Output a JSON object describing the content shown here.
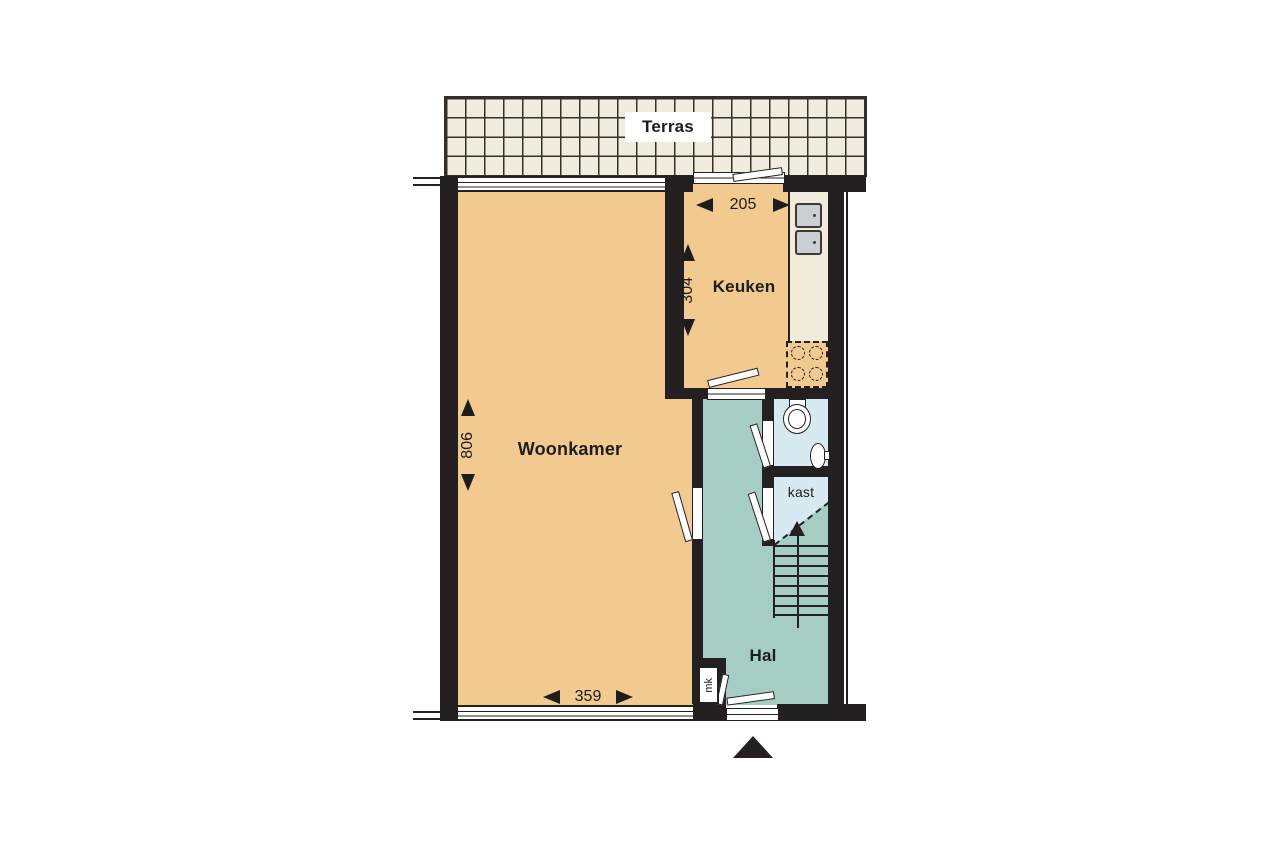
{
  "rooms": {
    "terras": {
      "label": "Terras"
    },
    "woonkamer": {
      "label": "Woonkamer"
    },
    "keuken": {
      "label": "Keuken"
    },
    "hal": {
      "label": "Hal"
    },
    "kast": {
      "label": "kast"
    },
    "meterkast": {
      "label": "mk"
    }
  },
  "dimensions": {
    "keuken_width": "205",
    "keuken_depth": "304",
    "woonkamer_depth": "806",
    "woonkamer_width": "359"
  },
  "colors": {
    "wall": "#242021",
    "ink": "#1d1d1b",
    "floor": "#f2c98f",
    "hall": "#a5cdc4",
    "closet": "#d8eaf1",
    "counter": "#f0ebdb",
    "tile": "#f0ecdf",
    "grid": "#33302c",
    "steel": "#cbcfd2"
  }
}
